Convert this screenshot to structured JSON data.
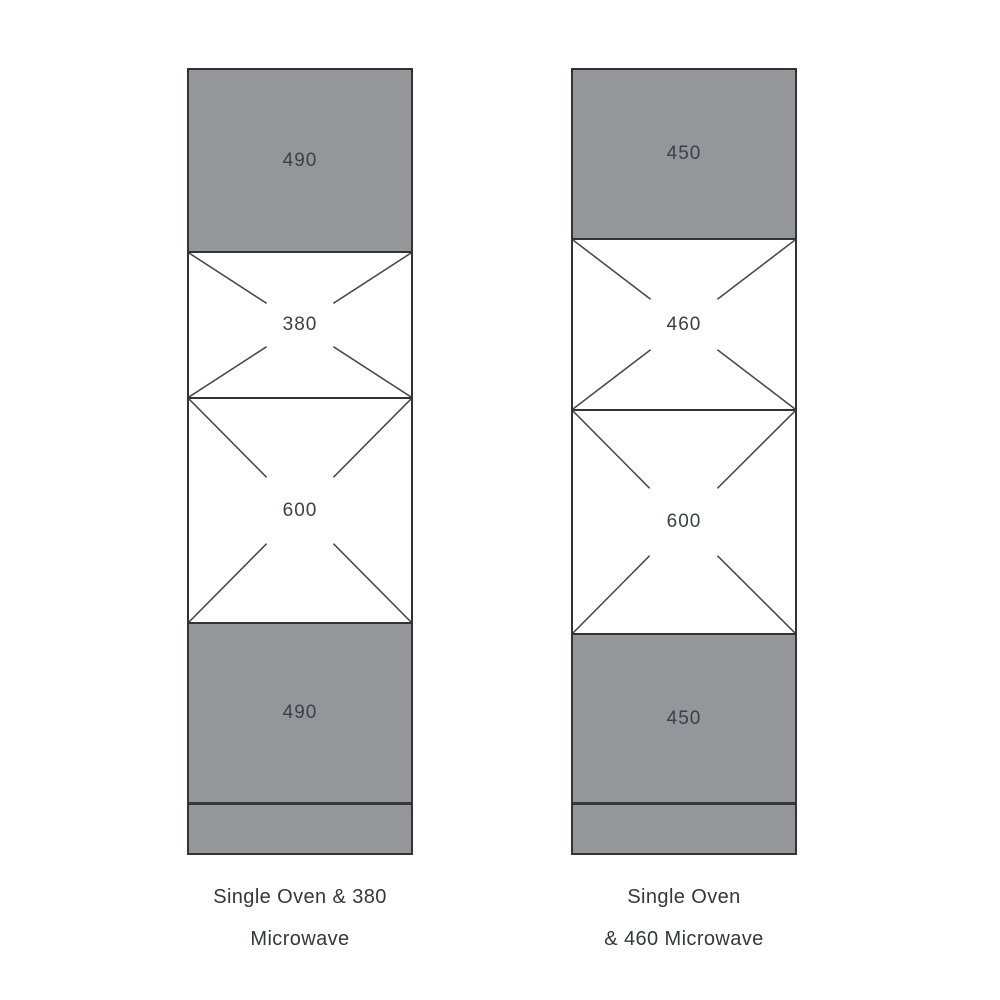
{
  "colors": {
    "panel_gray": "#95969a",
    "outline": "#333336",
    "divider_heavy": "#37373b",
    "cross_line": "#4a4a4d",
    "label_text": "#3c3f46",
    "caption_text": "#34373d",
    "page_bg": "#ffffff"
  },
  "columns": [
    {
      "caption_line1": "Single Oven & 380",
      "caption_line2": "Microwave",
      "sections": [
        {
          "name": "top-filler-panel",
          "label": "490"
        },
        {
          "name": "microwave-aperture",
          "label": "380"
        },
        {
          "name": "oven-aperture",
          "label": "600"
        },
        {
          "name": "bottom-filler-panel",
          "label": "490"
        },
        {
          "name": "plinth",
          "label": ""
        }
      ]
    },
    {
      "caption_line1": "Single Oven",
      "caption_line2": "& 460 Microwave",
      "sections": [
        {
          "name": "top-filler-panel",
          "label": "450"
        },
        {
          "name": "microwave-aperture",
          "label": "460"
        },
        {
          "name": "oven-aperture",
          "label": "600"
        },
        {
          "name": "bottom-filler-panel",
          "label": "450"
        },
        {
          "name": "plinth",
          "label": ""
        }
      ]
    }
  ]
}
